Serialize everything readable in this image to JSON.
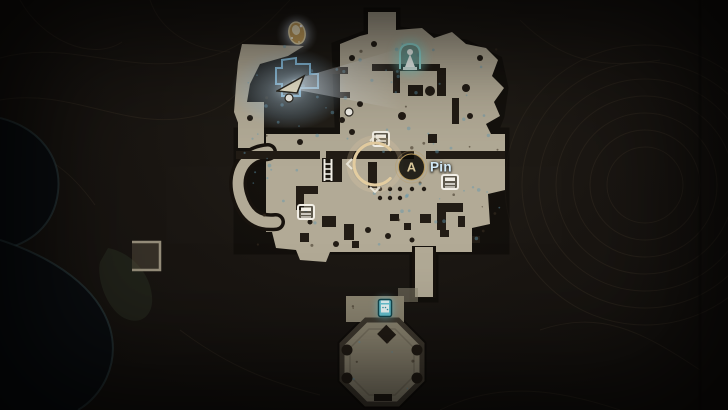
{
  "hud": {
    "pin_prompt": {
      "button": "A",
      "label": "Pin"
    }
  },
  "colors": {
    "terrain": "#181310",
    "terrain_line": "#332b21",
    "water": "#0a0d10",
    "map_floor": "#b2aa96",
    "map_floor_dim": "#8d8672",
    "wall": "#221c15",
    "building_outline": "#7fb9da",
    "merchant_glow": "#bcd9ea",
    "shrine_glow": "#82d6d1",
    "tent_fill": "#efe9d0",
    "icon_white": "#f2efe6",
    "gold": "#bb9c5e",
    "gold_text": "#d9c79a",
    "pin_text": "#d2e9f6",
    "typewriter_teal": "#67c4d2",
    "player_ring": "#e4cda0",
    "speckle": "#5f96af"
  },
  "map": {
    "icons": [
      {
        "type": "golden-emblem",
        "x": 297,
        "y": 33
      },
      {
        "type": "merchant-tent",
        "x": 291,
        "y": 85
      },
      {
        "type": "map-dot",
        "x": 289,
        "y": 98
      },
      {
        "type": "shrine-statue",
        "x": 410,
        "y": 56
      },
      {
        "type": "map-dot",
        "x": 349,
        "y": 112
      },
      {
        "type": "ladder-box",
        "x": 381,
        "y": 139
      },
      {
        "type": "ladder-tall",
        "x": 328,
        "y": 170
      },
      {
        "type": "ladder-box",
        "x": 306,
        "y": 212
      },
      {
        "type": "ladder-box",
        "x": 450,
        "y": 182
      },
      {
        "type": "typewriter",
        "x": 385,
        "y": 308
      },
      {
        "type": "player-ring",
        "x": 375,
        "y": 164
      },
      {
        "type": "pin-prompt",
        "x": 411,
        "y": 167
      }
    ]
  }
}
